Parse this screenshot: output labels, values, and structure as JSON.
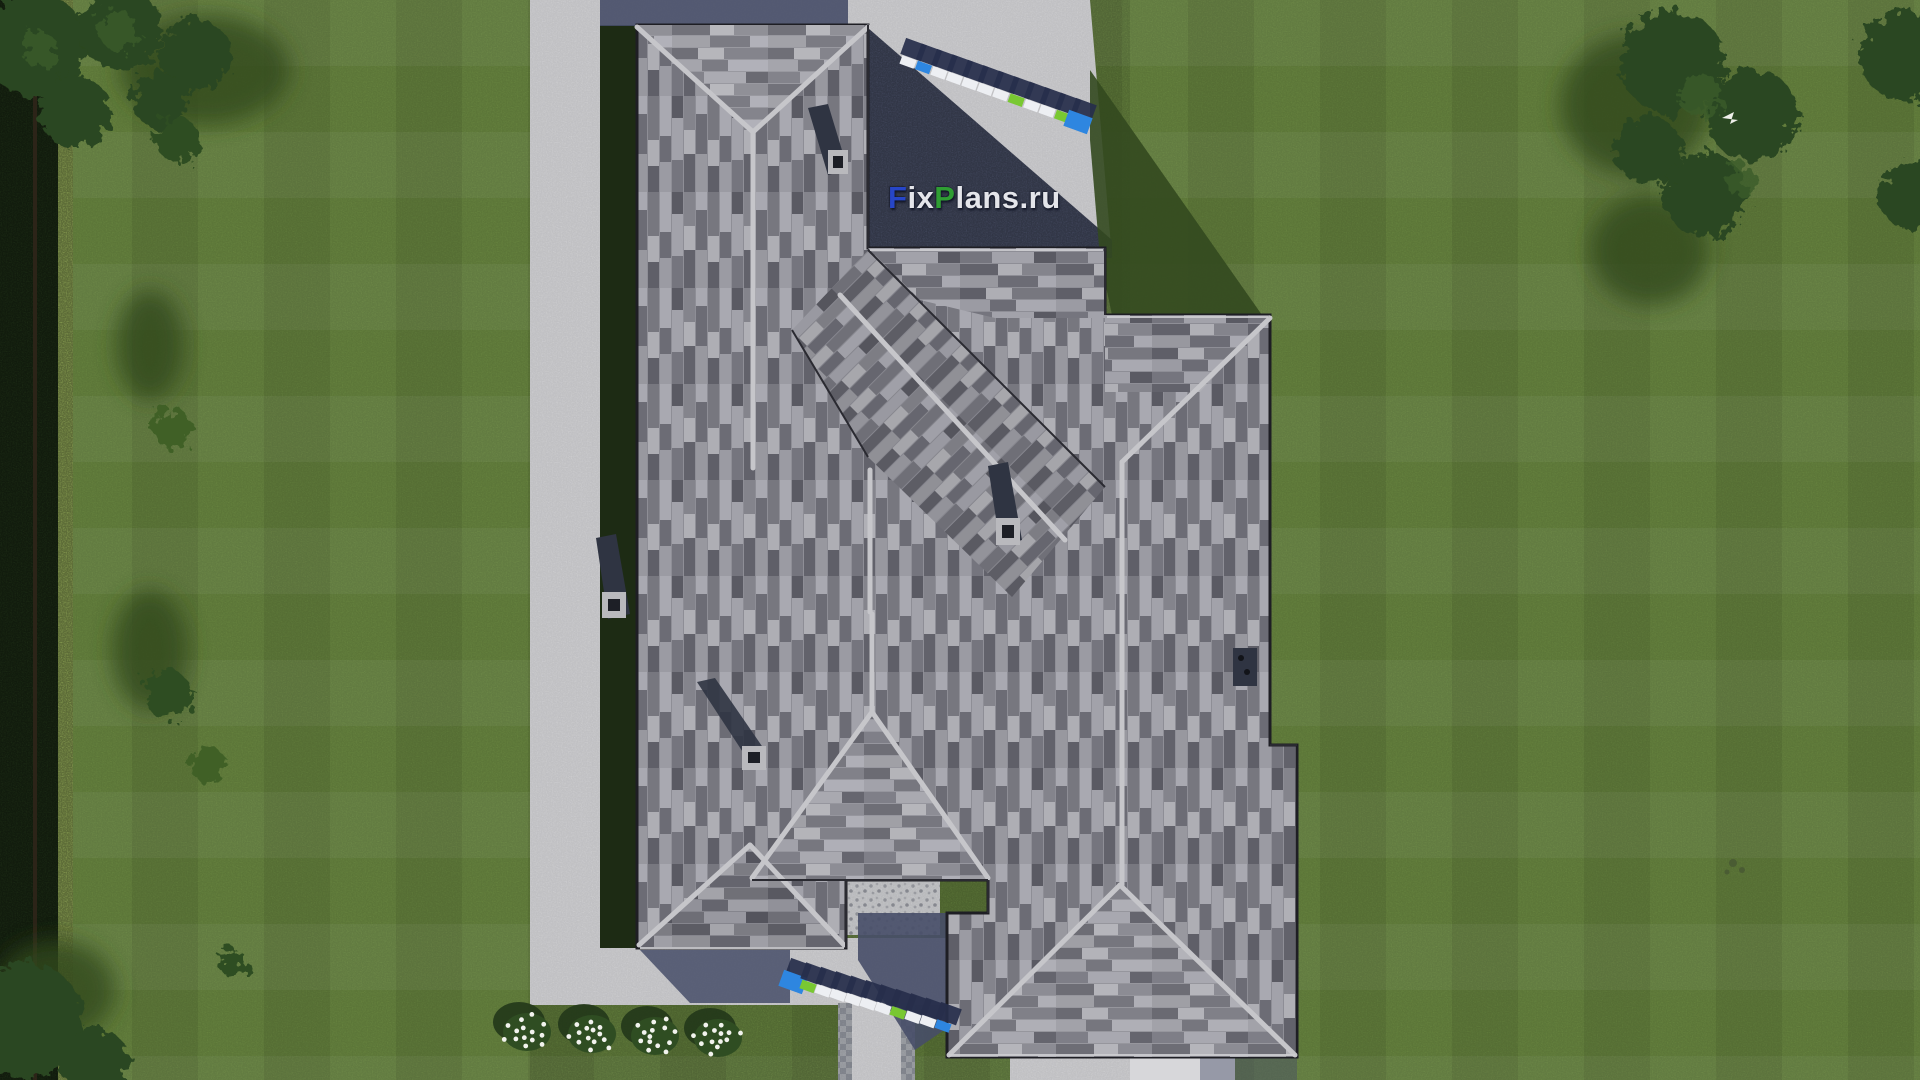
{
  "scene_description": "aerial-top-down-render-of-house-roof-on-lawn",
  "watermark": {
    "text": "FixPlans.ru",
    "segments": [
      {
        "text": "F",
        "color": "#2746c8"
      },
      {
        "text": "ix",
        "color": "#e4e5ea"
      },
      {
        "text": "P",
        "color": "#2f9e33"
      },
      {
        "text": "lans.ru",
        "color": "#e4e5ea"
      }
    ]
  },
  "ground_signs": [
    {
      "name": "ground-sign-top",
      "text": "FixPlans.ru",
      "x1": 908,
      "y1": 62,
      "x2": 1078,
      "y2": 122,
      "blocks": [
        {
          "c": "white"
        },
        {
          "c": "blue"
        },
        {
          "c": "white"
        },
        {
          "c": "white"
        },
        {
          "c": "white"
        },
        {
          "c": "white"
        },
        {
          "c": "white"
        },
        {
          "c": "green"
        },
        {
          "c": "white"
        },
        {
          "c": "white"
        },
        {
          "c": "green"
        },
        {
          "c": "blue",
          "big": true
        }
      ]
    },
    {
      "name": "ground-sign-bottom",
      "text": "FixPlans.ru",
      "x1": 793,
      "y1": 982,
      "x2": 943,
      "y2": 1026,
      "blocks": [
        {
          "c": "blue",
          "big": true
        },
        {
          "c": "green"
        },
        {
          "c": "white"
        },
        {
          "c": "white"
        },
        {
          "c": "white"
        },
        {
          "c": "white"
        },
        {
          "c": "white"
        },
        {
          "c": "green"
        },
        {
          "c": "white"
        },
        {
          "c": "white"
        },
        {
          "c": "blue"
        }
      ]
    }
  ],
  "flower_bed": {
    "items": [
      {
        "x": 527,
        "y": 1032
      },
      {
        "x": 592,
        "y": 1034
      },
      {
        "x": 655,
        "y": 1036
      },
      {
        "x": 718,
        "y": 1038
      }
    ]
  },
  "palette": {
    "lawn": "#6f8e44",
    "lawn_shadow": "#33491f",
    "hedge_dark": "#24381b",
    "hedge_light": "#a9c465",
    "tree_canopy": "#2b4720",
    "concrete": "#d7d7da",
    "concrete_shadow": "#474e68",
    "roof_light": "#a9a9b1",
    "roof_mid": "#8e8e96",
    "roof_dark": "#6c6c75",
    "roof_darker": "#5a5a63",
    "ridge_cap": "#c6c6ca",
    "fascia_dark": "#232329",
    "chimney": "#2f3442",
    "sign_navy": "#272e4b",
    "sign_white": "#edeff3",
    "sign_blue": "#2e86e0",
    "sign_green": "#79c832",
    "flower_white": "#f2f3ee",
    "bird_white": "#eeeeea"
  }
}
